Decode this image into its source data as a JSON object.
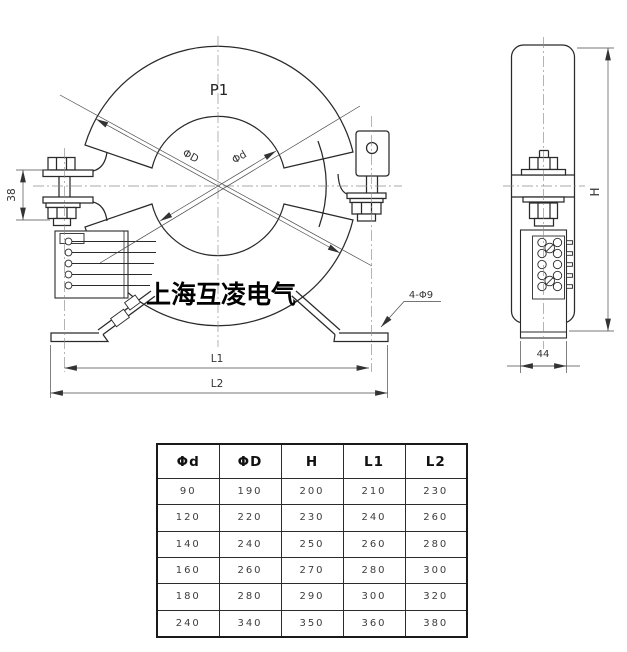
{
  "front_view": {
    "p1_label": "P1",
    "outer_dia_label": "ΦD",
    "inner_dia_label": "Φd",
    "clamp_dim": "38",
    "holes_label": "4-Φ9",
    "l1_label": "L1",
    "l2_label": "L2",
    "company": "上海互凌电气"
  },
  "side_view": {
    "height_label": "H",
    "width_dim": "44"
  },
  "table": {
    "headers": [
      "Φd",
      "ΦD",
      "H",
      "L1",
      "L2"
    ],
    "rows": [
      [
        "90",
        "190",
        "200",
        "210",
        "230"
      ],
      [
        "120",
        "220",
        "230",
        "240",
        "260"
      ],
      [
        "140",
        "240",
        "250",
        "260",
        "280"
      ],
      [
        "160",
        "260",
        "270",
        "280",
        "300"
      ],
      [
        "180",
        "280",
        "290",
        "300",
        "320"
      ],
      [
        "240",
        "340",
        "350",
        "360",
        "380"
      ]
    ]
  },
  "colors": {
    "line": "#2a2a2a",
    "dim_line": "#4a4a4a",
    "centerline": "#8c8c8c",
    "background": "#ffffff"
  }
}
